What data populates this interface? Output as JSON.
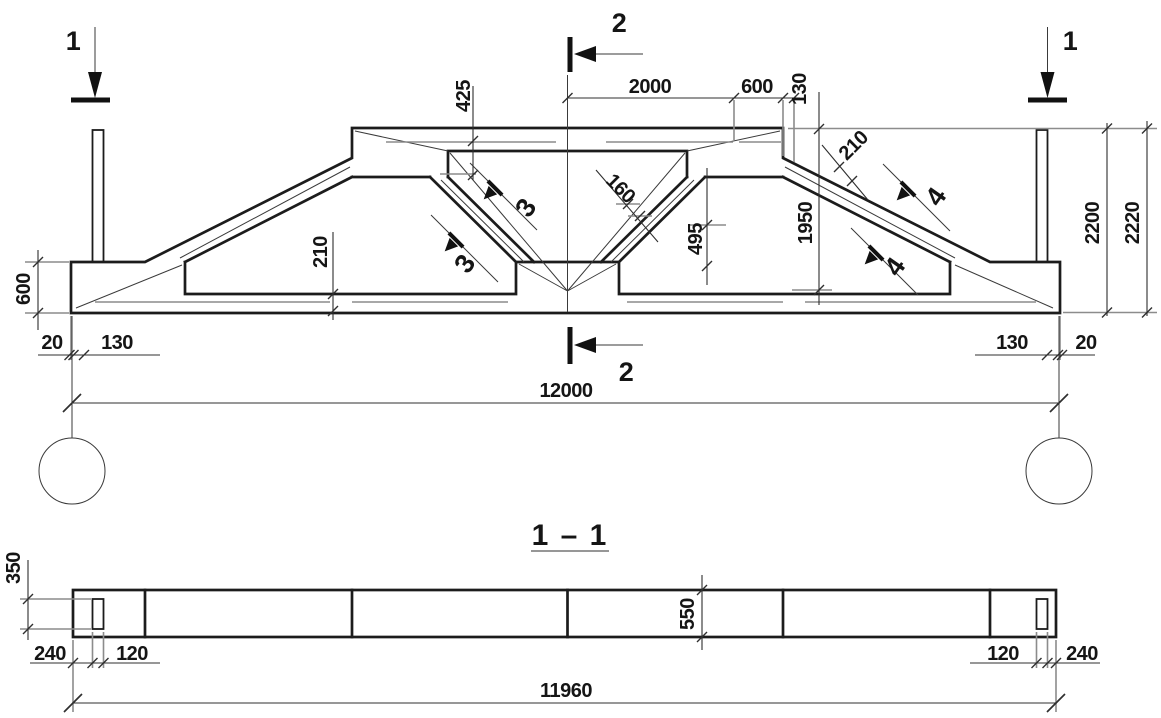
{
  "title": {
    "section_view_label": "1 – 1"
  },
  "elevation": {
    "section_markers": {
      "left_1": "1",
      "right_1": "1",
      "top_2": "2",
      "bottom_2": "2",
      "diag_3_upper": "3",
      "diag_3_lower": "3",
      "slope_4_upper": "4",
      "slope_4_lower": "4"
    },
    "dims": {
      "top_2000": "2000",
      "top_600": "600",
      "top_130": "130",
      "depth_425": "425",
      "diag_width_160": "160",
      "height_495": "495",
      "height_1950": "1950",
      "slope_thickness_210": "210",
      "chord_depth_210": "210",
      "height_2200": "2200",
      "height_2220": "2220",
      "end_height_600": "600",
      "bottom_left_20": "20",
      "bottom_left_130": "130",
      "bottom_right_130": "130",
      "bottom_right_20": "20",
      "span_12000": "12000"
    }
  },
  "plan": {
    "dims": {
      "slot_length_350": "350",
      "left_240": "240",
      "left_120": "120",
      "width_550": "550",
      "right_120": "120",
      "right_240": "240",
      "length_11960": "11960"
    }
  }
}
